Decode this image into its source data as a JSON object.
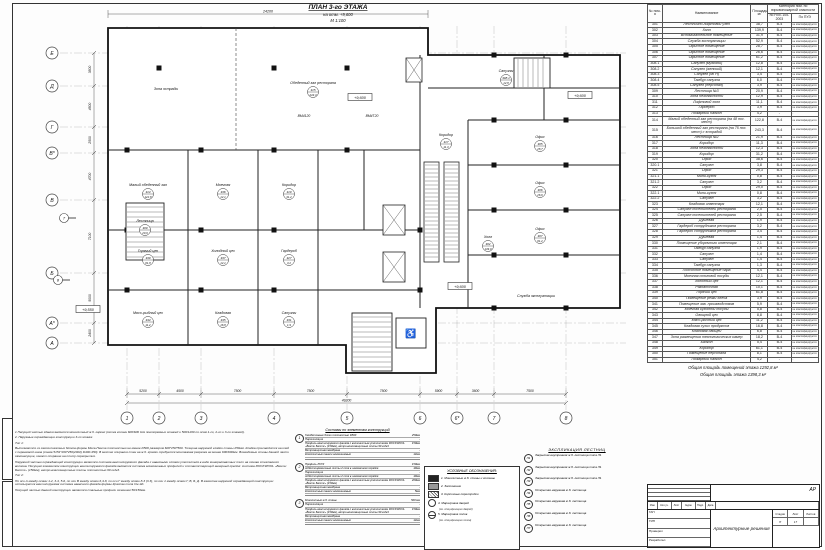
{
  "sheet": {
    "title": "ПЛАН 3-го ЭТАЖА",
    "subtitle": "на отм. +9,600",
    "scale": "М 1:100"
  },
  "plan": {
    "outline": "100,28 420,28 420,55 612,55 612,308 428,308 428,373 338,373 338,345 100,345",
    "walls": [
      [
        412,
        55,
        412,
        308
      ],
      [
        460,
        120,
        460,
        308
      ],
      [
        460,
        120,
        612,
        120
      ],
      [
        460,
        165,
        612,
        165
      ],
      [
        460,
        210,
        612,
        210
      ],
      [
        460,
        255,
        612,
        255
      ],
      [
        420,
        88,
        612,
        88
      ],
      [
        536,
        55,
        536,
        120
      ],
      [
        100,
        150,
        412,
        150
      ],
      [
        180,
        150,
        180,
        345
      ],
      [
        250,
        150,
        250,
        345
      ],
      [
        310,
        150,
        310,
        345
      ],
      [
        100,
        230,
        310,
        230
      ],
      [
        100,
        290,
        310,
        290
      ],
      [
        310,
        230,
        412,
        230
      ],
      [
        310,
        290,
        412,
        290
      ],
      [
        356,
        150,
        356,
        230
      ]
    ],
    "dashed_walls": [
      [
        228,
        28,
        228,
        150
      ]
    ],
    "columns": [
      [
        151,
        68
      ],
      [
        266,
        68
      ],
      [
        339,
        68
      ],
      [
        119,
        150
      ],
      [
        193,
        150
      ],
      [
        266,
        150
      ],
      [
        339,
        150
      ],
      [
        119,
        230
      ],
      [
        193,
        230
      ],
      [
        266,
        230
      ],
      [
        119,
        290
      ],
      [
        193,
        290
      ],
      [
        266,
        290
      ],
      [
        486,
        55
      ],
      [
        558,
        55
      ],
      [
        486,
        120
      ],
      [
        558,
        120
      ],
      [
        486,
        165
      ],
      [
        558,
        165
      ],
      [
        486,
        210
      ],
      [
        558,
        210
      ],
      [
        486,
        255
      ],
      [
        558,
        255
      ],
      [
        486,
        308
      ],
      [
        558,
        308
      ],
      [
        412,
        230
      ],
      [
        412,
        290
      ]
    ],
    "escalators": [
      [
        416,
        162,
        15,
        100
      ],
      [
        436,
        162,
        15,
        100
      ]
    ],
    "stairs": [
      {
        "x": 118,
        "y": 203,
        "w": 38,
        "h": 57,
        "dir": "h"
      },
      {
        "x": 506,
        "y": 58,
        "w": 36,
        "h": 30,
        "dir": "v"
      },
      {
        "x": 344,
        "y": 313,
        "w": 40,
        "h": 58,
        "dir": "h"
      }
    ],
    "lift": {
      "x": 388,
      "y": 318,
      "w": 30,
      "h": 30
    },
    "elevators": [
      [
        375,
        205,
        22,
        30
      ],
      [
        375,
        252,
        22,
        30
      ],
      [
        398,
        58,
        16,
        24
      ]
    ],
    "grid_cols": [
      {
        "label": "1",
        "x": 119
      },
      {
        "label": "2",
        "x": 151
      },
      {
        "label": "3",
        "x": 193
      },
      {
        "label": "4",
        "x": 266
      },
      {
        "label": "5",
        "x": 339
      },
      {
        "label": "6",
        "x": 412
      },
      {
        "label": "6*",
        "x": 449
      },
      {
        "label": "7",
        "x": 486
      },
      {
        "label": "8",
        "x": 558
      }
    ],
    "grid_rows": [
      {
        "label": "Е",
        "y": 53
      },
      {
        "label": "Д",
        "y": 86
      },
      {
        "label": "Г",
        "y": 127
      },
      {
        "label": "В*",
        "y": 153
      },
      {
        "label": "В",
        "y": 200
      },
      {
        "label": "Б",
        "y": 273
      },
      {
        "label": "А*",
        "y": 323
      },
      {
        "label": "А",
        "y": 343
      }
    ],
    "dims_bottom": [
      "5200",
      "4500",
      "7500",
      "7500",
      "7500",
      "5900",
      "3600",
      "7500"
    ],
    "dim_total": "49200",
    "dims_left": [
      "3500",
      "4500",
      "2500",
      "4700",
      "7100",
      "5000",
      "2400"
    ],
    "dim_top": "24200",
    "rooms": [
      {
        "text": "Зона эстрады",
        "x": 158,
        "y": 90
      },
      {
        "text": "Обеденный зал ресторана",
        "x": 305,
        "y": 84,
        "num": "315",
        "area": "243,3"
      },
      {
        "text": "Малый обеденный зал",
        "x": 140,
        "y": 186,
        "num": "314",
        "area": "122,8"
      },
      {
        "text": "Моечная",
        "x": 215,
        "y": 186,
        "num": "336",
        "area": "12,1"
      },
      {
        "text": "Коридор",
        "x": 281,
        "y": 186,
        "num": "319",
        "area": "31,2"
      },
      {
        "text": "Горячий цех",
        "x": 140,
        "y": 252,
        "num": "339",
        "area": "61,8"
      },
      {
        "text": "Холодный цех",
        "x": 215,
        "y": 252,
        "num": "337",
        "area": "12,1"
      },
      {
        "text": "Гардероб",
        "x": 281,
        "y": 252,
        "num": "327",
        "area": "3,2"
      },
      {
        "text": "Мясо-рыбный цех",
        "x": 140,
        "y": 314,
        "num": "344",
        "area": "11,2"
      },
      {
        "text": "Кладовая",
        "x": 215,
        "y": 314,
        "num": "345",
        "area": "16,8"
      },
      {
        "text": "Санузлы",
        "x": 281,
        "y": 314,
        "num": "331",
        "area": "1,9"
      },
      {
        "text": "Холл",
        "x": 480,
        "y": 238,
        "num": "302",
        "area": "139,9"
      },
      {
        "text": "Служба эксплуатации",
        "x": 528,
        "y": 297
      },
      {
        "text": "Офис",
        "x": 532,
        "y": 138,
        "num": "305",
        "area": "28,7"
      },
      {
        "text": "Офис",
        "x": 532,
        "y": 184,
        "num": "306",
        "area": "26,6"
      },
      {
        "text": "Офис",
        "x": 532,
        "y": 230,
        "num": "307",
        "area": "61,2"
      },
      {
        "text": "Санузлы",
        "x": 498,
        "y": 72,
        "num": "308.1",
        "area": "12,8"
      },
      {
        "text": "Лестница",
        "x": 137,
        "y": 222,
        "num": "309",
        "area": "20,9"
      },
      {
        "text": "Коридор",
        "x": 438,
        "y": 136,
        "num": "317",
        "area": "11,3"
      }
    ],
    "elevations": [
      {
        "text": "+9,600",
        "x": 352,
        "y": 98
      },
      {
        "text": "+9,600",
        "x": 572,
        "y": 96
      },
      {
        "text": "+9,600",
        "x": 452,
        "y": 287
      },
      {
        "text": "+9,550",
        "x": 80,
        "y": 310
      }
    ],
    "beam_marks": [
      {
        "text": "ВМ4120",
        "x": 296,
        "y": 117
      },
      {
        "text": "ВМ4Т20",
        "x": 364,
        "y": 117
      }
    ],
    "sections": [
      {
        "label": "7",
        "x": 56,
        "y": 218
      },
      {
        "label": "8",
        "x": 50,
        "y": 280
      }
    ],
    "wheelchair_icon": "♿"
  },
  "explication": {
    "headers": {
      "num": "№ пом-я",
      "name": "Наименование",
      "area": "Площадь м²",
      "cat_group": "Категория пом. по взрывопожарной опасности",
      "npb": "по НПБ 105-2003",
      "pue": "По ПУЭ"
    },
    "pue_note": "не классифицируется",
    "rows": [
      [
        "301",
        "Лестнично-лифтовой узел",
        "38,7",
        "В-4"
      ],
      [
        "302",
        "Холл",
        "139,9",
        "В-4"
      ],
      [
        "303",
        "Вспомогательное помещение",
        "31,9",
        "В-4"
      ],
      [
        "304",
        "Служба эксплуатации",
        "52,9",
        "В-4"
      ],
      [
        "305",
        "Офисное помещение",
        "28,7",
        "В-4"
      ],
      [
        "306",
        "Офисное помещение",
        "26,6",
        "В-4"
      ],
      [
        "307",
        "Офисное помещение",
        "61,2",
        "В-4"
      ],
      [
        "308.1",
        "Санузел (мужской)",
        "12,8",
        "В-4"
      ],
      [
        "308.2",
        "Санузел (женский)",
        "12,1",
        "В-4"
      ],
      [
        "308.3",
        "Санузел (МГН)",
        "3,4",
        "В-4"
      ],
      [
        "308.4",
        "Тамбур санузла",
        "6,0",
        "В-4"
      ],
      [
        "308.5",
        "Санузел (персонал)",
        "3,9",
        "В-4"
      ],
      [
        "309",
        "Лестница №3",
        "20,9",
        "В-4"
      ],
      [
        "310",
        "Зона безопасности",
        "12,9",
        "В-4"
      ],
      [
        "311",
        "Лифтовой холл",
        "11,1",
        "В-4"
      ],
      [
        "312",
        "Гардероб",
        "3,9",
        "В-4"
      ],
      [
        "313",
        "Пожарный балкон",
        "4,2",
        "-"
      ],
      [
        "314",
        "Малый обеденный зал ресторана (на 48 пос. мест)",
        "122,8",
        "В-4"
      ],
      [
        "315",
        "Большой обеденный зал ресторана (на 75 пос. мест) с эстрадой",
        "243,3",
        "В-4"
      ],
      [
        "316",
        "Лестница №2",
        "21,9",
        "В-4"
      ],
      [
        "317",
        "Коридор",
        "11,3",
        "В-4"
      ],
      [
        "318",
        "Зона безопасности",
        "12,3",
        "В-4"
      ],
      [
        "319",
        "Коридор",
        "31,2",
        "В-4"
      ],
      [
        "320",
        "Офис",
        "38,6",
        "В-4"
      ],
      [
        "320.1",
        "Санузел",
        "3,8",
        "В-4"
      ],
      [
        "321",
        "Офис",
        "29,3",
        "В-4"
      ],
      [
        "321.1",
        "Мини-кухня",
        "0,8",
        "В-4"
      ],
      [
        "321.2",
        "Санузел",
        "3,2",
        "В-4"
      ],
      [
        "322",
        "Офис",
        "29,0",
        "В-4"
      ],
      [
        "322.1",
        "Мини-кухня",
        "0,8",
        "В-4"
      ],
      [
        "322.2",
        "Санузел",
        "3,2",
        "В-4"
      ],
      [
        "323",
        "Кладовая инвентаря",
        "12,1",
        "В-4"
      ],
      [
        "324",
        "Санузел посетителей ресторана",
        "2,5",
        "В-4"
      ],
      [
        "325",
        "Санузел посетителей ресторана",
        "2,5",
        "В-4"
      ],
      [
        "326",
        "Душевая",
        "1,9",
        "В-4"
      ],
      [
        "327",
        "Гардероб сотрудников ресторана",
        "3,2",
        "В-4"
      ],
      [
        "328",
        "Гардероб сотрудников ресторана",
        "3,4",
        "В-4"
      ],
      [
        "329",
        "Душевая",
        "1,4",
        "В-4"
      ],
      [
        "330",
        "Помещение уборочного инвентаря",
        "2,1",
        "В-4"
      ],
      [
        "331",
        "Тамбур санузла",
        "1,9",
        "В-4"
      ],
      [
        "332",
        "Санузел",
        "1,4",
        "В-4"
      ],
      [
        "333",
        "Санузел",
        "1,4",
        "В-4"
      ],
      [
        "334",
        "Тамбур санузла",
        "1,3",
        "В-4"
      ],
      [
        "335",
        "Подсобное помещение бара",
        "4,4",
        "В-4"
      ],
      [
        "336",
        "Моечная столовой посуды",
        "12,1",
        "В-4"
      ],
      [
        "337",
        "Холодный цех",
        "12,1",
        "В-4"
      ],
      [
        "338",
        "Раздаточная",
        "10,1",
        "В-4"
      ],
      [
        "339",
        "Горячий цех",
        "61,8",
        "В-4"
      ],
      [
        "340",
        "Помещение резки хлеба",
        "3,9",
        "В-4"
      ],
      [
        "341",
        "Помещение зав. производством",
        "5,9",
        "В-4"
      ],
      [
        "342",
        "Моечная кухонной посуды",
        "5,8",
        "В-4"
      ],
      [
        "343",
        "Овощной цех",
        "8,8",
        "В-4"
      ],
      [
        "344",
        "Мясо-рыбный цех",
        "11,2",
        "В-4"
      ],
      [
        "345",
        "Кладовая сухих продуктов",
        "16,8",
        "В-4"
      ],
      [
        "346",
        "Кладовая овощей",
        "6,8",
        "В-4"
      ],
      [
        "347",
        "Зона размещения технологических камер",
        "18,2",
        "В-4"
      ],
      [
        "348",
        "Балкон",
        "5,4",
        "В-4"
      ],
      [
        "349",
        "Коридор",
        "61,1",
        "В-4"
      ],
      [
        "350",
        "Помещение персонала",
        "8,1",
        "В-4"
      ],
      [
        "351",
        "Пожарный балкон",
        "4,2",
        "-"
      ]
    ],
    "totals": [
      "Общая площадь помещений этажа 1292,8 м²",
      "Общая площадь этажа 1398,3 м²"
    ]
  },
  "legend": {
    "title": "УСЛОВНЫЕ ОБОЗНАЧЕНИЯ:",
    "items": [
      {
        "swatch": "solid",
        "text": "1. Монолитные ж.б. стены и колонны",
        "sub": ""
      },
      {
        "swatch": "gray",
        "text": "2. Заполнение",
        "sub": ""
      },
      {
        "swatch": "hatch",
        "text": "3. Кирпичные перегородки",
        "sub": ""
      },
      {
        "swatch": "circle",
        "text": "4. Маркировка дверей",
        "sub": "(см. спецификацию дверей)"
      },
      {
        "swatch": "circle2",
        "text": "5. Маркировка полов",
        "sub": "(см. спецификацию полов)"
      }
    ]
  },
  "stairs_expl": {
    "title": "ЭКСПЛИКАЦИЯ ЛЕСТНИЦ",
    "items": [
      {
        "mark": "Л1",
        "text": "Закрытая внутренняя ж.б. лестница типа Л1"
      },
      {
        "mark": "Л2",
        "text": "Закрытая внутренняя ж.б. лестница типа Л1"
      },
      {
        "mark": "Л3",
        "text": "Закрытая внутренняя ж.б. лестница типа Л1"
      },
      {
        "mark": "Л4",
        "text": "Открытая наружная ж.б. лестница"
      },
      {
        "mark": "Л5",
        "text": "Открытая наружная ж.б. лестница"
      },
      {
        "mark": "Л6",
        "text": "Открытая наружная ж.б. лестница"
      },
      {
        "mark": "Л7",
        "text": "Открытая наружная ж.б. лестница"
      }
    ]
  },
  "specs": {
    "title": "Составы по элементам конструкций",
    "panels": [
      {
        "mark": "1",
        "lines": [
          [
            "Газобетонные блоки плотностью D500",
            "250мм"
          ],
          [
            "Пароизоляция",
            "-"
          ],
          [
            "Профиль вентилируемого фасада с волокнистым утеплителем ROCKWOOL «Венти Баттс» (150мм), ветро-влагозащитные плиты 90 кг/м3",
            "150мм"
          ],
          [
            "Ветрозащитная мембрана",
            "-"
          ],
          [
            "Композитные панели алюминиевые",
            "12мм"
          ]
        ]
      },
      {
        "mark": "2",
        "lines": [
          [
            "Профиль ЛСТК",
            "150мм"
          ],
          [
            "Асбестоцементные листы 2 слоя в шахматном порядке",
            "10мм"
          ],
          [
            "Пароизоляция",
            "-"
          ],
          [
            "Асбестоцементные листы 2 слоя в шахматном порядке",
            "10мм"
          ],
          [
            "Профиль вентилируемого фасада с волокнистым утеплителем ROCKWOOL «Венти Баттс» (150мм)",
            "200мм"
          ],
          [
            "Ветрозащитная мембрана",
            "-"
          ],
          [
            "Композитные панели алюминиевые",
            "5мм"
          ]
        ]
      },
      {
        "mark": "3",
        "lines": [
          [
            "Монолитные ж.б. стены",
            "500 мм"
          ],
          [
            "Пароизоляция",
            "-"
          ],
          [
            "Профиль вентилируемого фасада с волокнистым утеплителем ROCKWOOL «Венти Баттс» (150мм), ветро-влагозащитные плиты 90 кг/м3",
            "150мм"
          ],
          [
            "Ветрозащитная мембрана",
            "-"
          ],
          [
            "Композитные панели алюминиевые",
            "12мм"
          ]
        ]
      }
    ]
  },
  "notes": {
    "paragraphs": [
      "1 Несущей частью здания является монолитный ж.б. каркас (сетка колонн 600/600 для повторяемых этажей и 500/1200 по осям 1-го, 2-го и 3-го этажей).",
      "2. Наружные ограждающие конструкции 3-го этажа:",
      "Тип 1:",
      "Выполняются из газосиликатных блоков фирмы Меса-Пента плотностью не менее D500 размером 600*250*500. Толщина наружной кладки стены 250мм. Кладка производится на клей с перевязкой швов (схема 5151*200*250(2002) D400-450). В местах опирания стен на ж.б. кромки требуется монтажная разрезка не менее 600/600мм. Возводимые стены данной части самонесущие, имеют опирание на плиту перекрытия.",
      "Наружной частью ограждающей конструкции является система вентилируемого фасада с навесными слоями утеплителя в виде минераловатных плит на основе стеклянного волокна. Несущим элементом конструкции вентилируемого фасада является система алюминиевых профилей и соответствующий анкерный крепёж: система ROCKWOOL «Венти Баттс» (150мм), ветро-влагозащитные плиты плотностью 90 кг/м3.",
      "Тип 2:",
      "По оси А между осями 1-2, 3-4, 5-6, по оси В между осями 6,4-8, по оси Г между осями 8-3 (3.3), по оси 1 между осями Г, В, Б, Д. В качестве наружной ограждающей конструкции используется вентилируемая система навесного фасада фирмы Краспан типа См-Эд.",
      "Несущей частью данной конструкции являются стальные профили сечением 50/150мм."
    ]
  },
  "stamp": {
    "doc_code": "АР",
    "rev_headers": [
      "Изм.",
      "Кол.уч.",
      "Лист",
      "№док.",
      "Подп.",
      "Дата"
    ],
    "roles": [
      "ГАП",
      "ГИП",
      "Проверил",
      "Разработал"
    ],
    "project_title": "Архитектурные решения",
    "stage_label": "Стадия",
    "sheet_label": "Лист",
    "sheets_label": "Листов",
    "stage": "П",
    "sheet": "17",
    "sheets": ""
  }
}
